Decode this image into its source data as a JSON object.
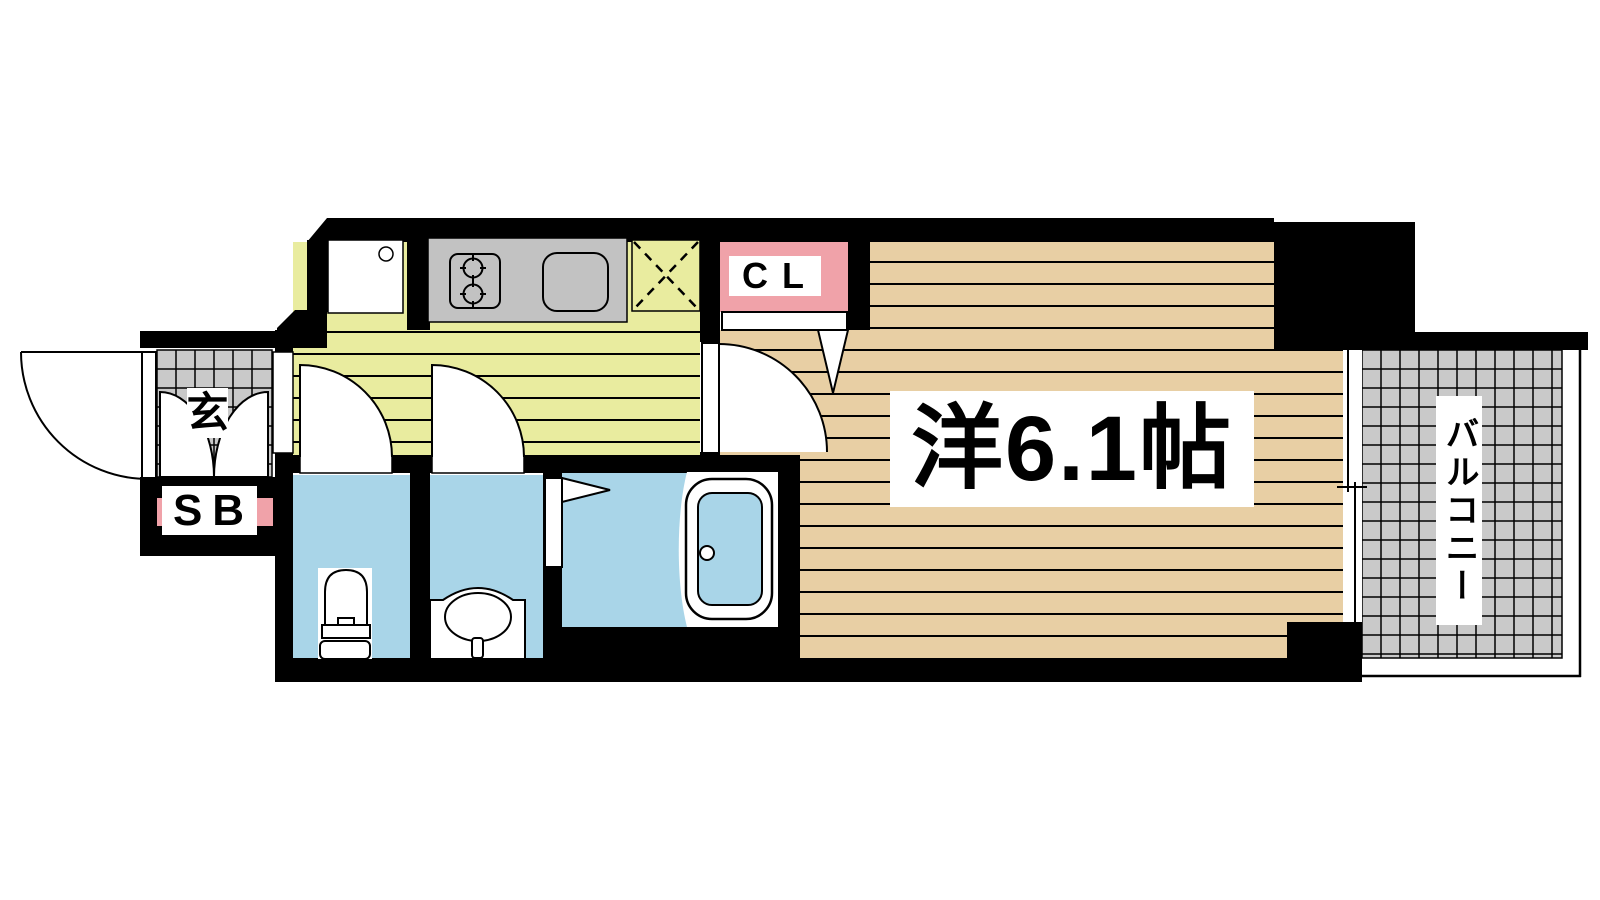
{
  "floorplan": {
    "type": "apartment-1K-floor-plan",
    "labels": {
      "entrance": "玄",
      "shoe_box": "SB",
      "closet": "CL",
      "western_room": "洋6.1帖",
      "balcony": "バルコニー"
    },
    "rooms": {
      "western_room_size_tatami": "6.1帖"
    },
    "colors": {
      "wall": "#000000",
      "kitchen_floor": "#e9ec9f",
      "room_floor": "#e8cfa4",
      "wet_area_floor": "#a9d5e8",
      "closet_accent": "#f0a2a9",
      "tile_gray": "#c9c9c9",
      "counter_gray": "#c2c2c2"
    }
  }
}
